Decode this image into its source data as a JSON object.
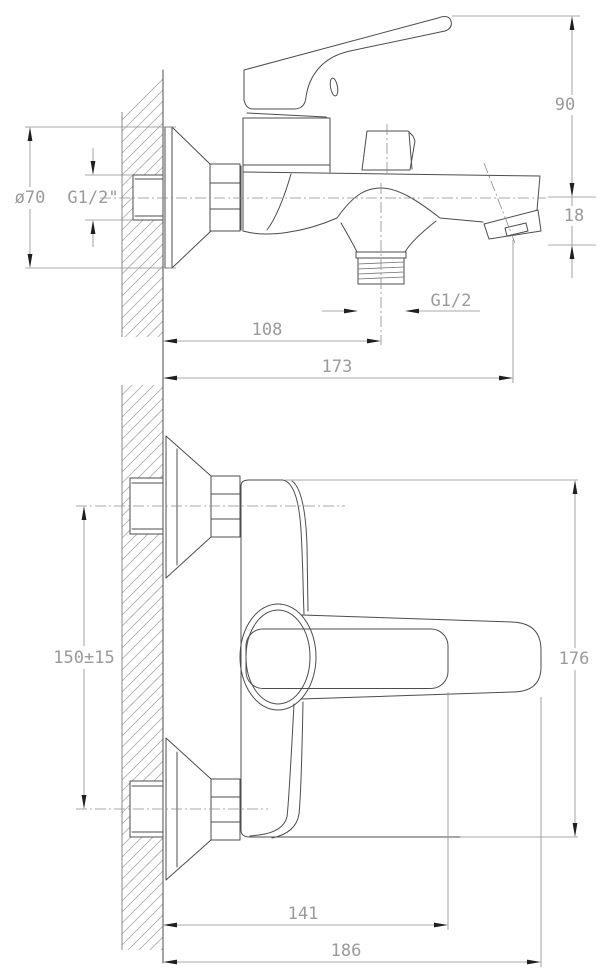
{
  "drawing": {
    "title": "wall-mounted bath mixer tap technical drawing",
    "side_view": {
      "dim_handle_height": "90",
      "dim_aerator_drop": "18",
      "dim_flange_diameter": "ø70",
      "dim_inlet_thread": "G1/2\"",
      "dim_outlet_thread": "G1/2",
      "dim_shower_outlet_offset": "108",
      "dim_spout_reach": "173"
    },
    "plan_view": {
      "dim_inlet_spacing": "150±15",
      "dim_body_length": "176",
      "dim_lever_reach": "141",
      "dim_overall_reach": "186"
    }
  }
}
